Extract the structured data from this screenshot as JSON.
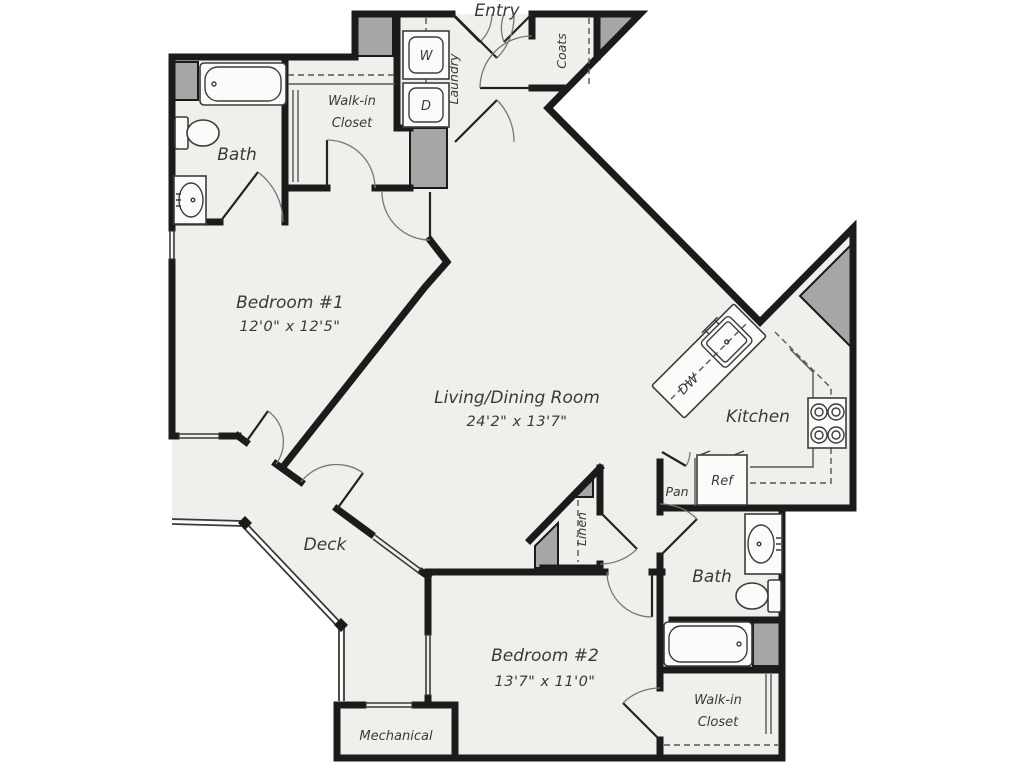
{
  "palette": {
    "background": "#ffffff",
    "floor": "#f0efec",
    "wall": "#1b1b1b",
    "shaded_block": "#a6a6a6",
    "fixture_line": "#3c3c3c",
    "label_text": "#3a3a3a"
  },
  "rooms": {
    "entry": {
      "label": "Entry"
    },
    "laundry": {
      "label": "Laundry",
      "washer": "W",
      "dryer": "D"
    },
    "coats": {
      "label": "Coats"
    },
    "walk_in_closet_1": {
      "line1": "Walk-in",
      "line2": "Closet"
    },
    "bath_1": {
      "label": "Bath"
    },
    "bedroom_1": {
      "label": "Bedroom #1",
      "dimensions": "12'0\" x 12'5\""
    },
    "living_dining": {
      "label": "Living/Dining Room",
      "dimensions": "24'2\" x 13'7\""
    },
    "kitchen": {
      "label": "Kitchen",
      "dishwasher": "DW",
      "refrigerator": "Ref",
      "pantry": "Pan"
    },
    "deck": {
      "label": "Deck"
    },
    "linen": {
      "label": "Linen"
    },
    "bath_2": {
      "label": "Bath"
    },
    "bedroom_2": {
      "label": "Bedroom #2",
      "dimensions": "13'7\" x 11'0\""
    },
    "walk_in_closet_2": {
      "line1": "Walk-in",
      "line2": "Closet"
    },
    "mechanical": {
      "label": "Mechanical"
    }
  }
}
